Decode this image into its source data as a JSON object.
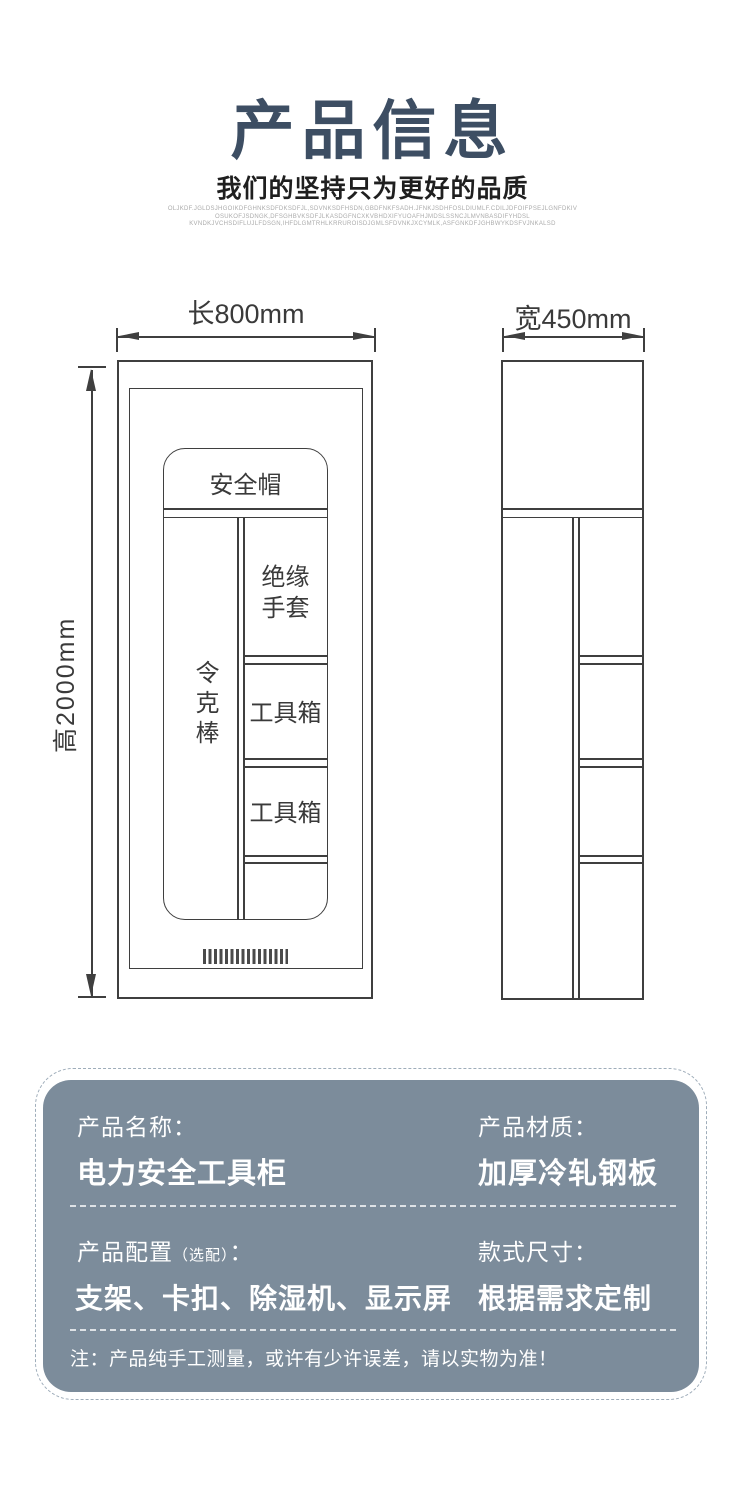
{
  "header": {
    "title": "产品信息",
    "subtitle": "我们的坚持只为更好的品质",
    "fine_print": [
      "OLJKDF.JGLDSJHGOIKDFGHNKSDFDKSDFJL,SDVNKSDFHSDN,GBDFNKFSADH.JFNKJSDHFOSLDIUMLF.CDILJDFOIFPSEJLGNFDKIV",
      "OSUKOFJSDNGK,DFSGHBVKSDFJLKASDGFNCXKVBHDXIFYUOAFHJMDSLSSNCJLMVNBASDIFYHDSL",
      "KVNDKJVCHSDIFLUJLFDSGN,IHFDLGMTRHLKRRUROISDJGMLSFDVNKJXCYMLK,ASFGNKDFJGHBWYKDSFVJNKALSD"
    ]
  },
  "front_view": {
    "width_label": "长800mm",
    "height_label": "高2000mm",
    "helmet_label": "安全帽",
    "rod_label": "令克棒",
    "gloves_line1": "绝缘",
    "gloves_line2": "手套",
    "toolbox1_label": "工具箱",
    "toolbox2_label": "工具箱"
  },
  "side_view": {
    "width_label": "宽450mm"
  },
  "info_card": {
    "name_label": "产品名称：",
    "name_value": "电力安全工具柜",
    "material_label": "产品材质：",
    "material_value": "加厚冷轧钢板",
    "config_label": "产品配置",
    "config_label_sub": "（选配）",
    "config_colon": "：",
    "config_value": "支架、卡扣、除湿机、显示屏",
    "size_label": "款式尺寸：",
    "size_value": "根据需求定制",
    "note": "注：产品纯手工测量，或许有少许误差，请以实物为准！"
  },
  "colors": {
    "accent": "#3d4e63",
    "card_bg": "#7c8c9b",
    "line": "#3f3f3f"
  }
}
